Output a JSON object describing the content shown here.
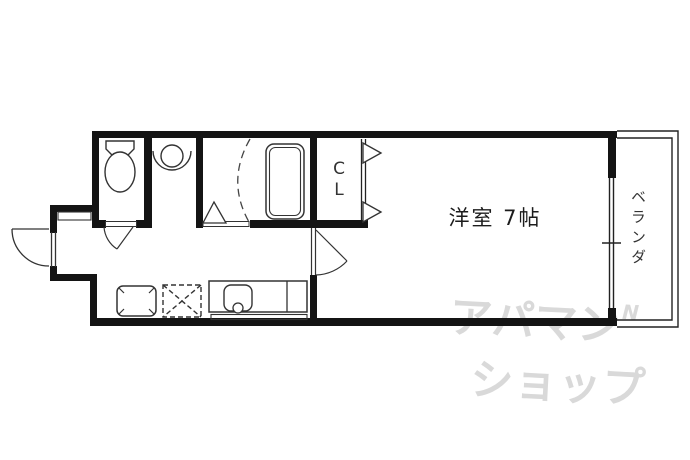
{
  "plan": {
    "rooms": {
      "main_room": {
        "label": "洋室 7帖"
      },
      "closet": {
        "label": "CL",
        "chars": [
          "C",
          "L"
        ]
      },
      "veranda": {
        "label": "ベランダ"
      }
    },
    "colors": {
      "wall": "#141414",
      "line": "#222222",
      "background": "#ffffff",
      "watermark": "#d9d9d9",
      "text": "#222222"
    }
  },
  "watermark": {
    "line1": "アパマン",
    "mark": "N",
    "line2": "ショップ"
  }
}
